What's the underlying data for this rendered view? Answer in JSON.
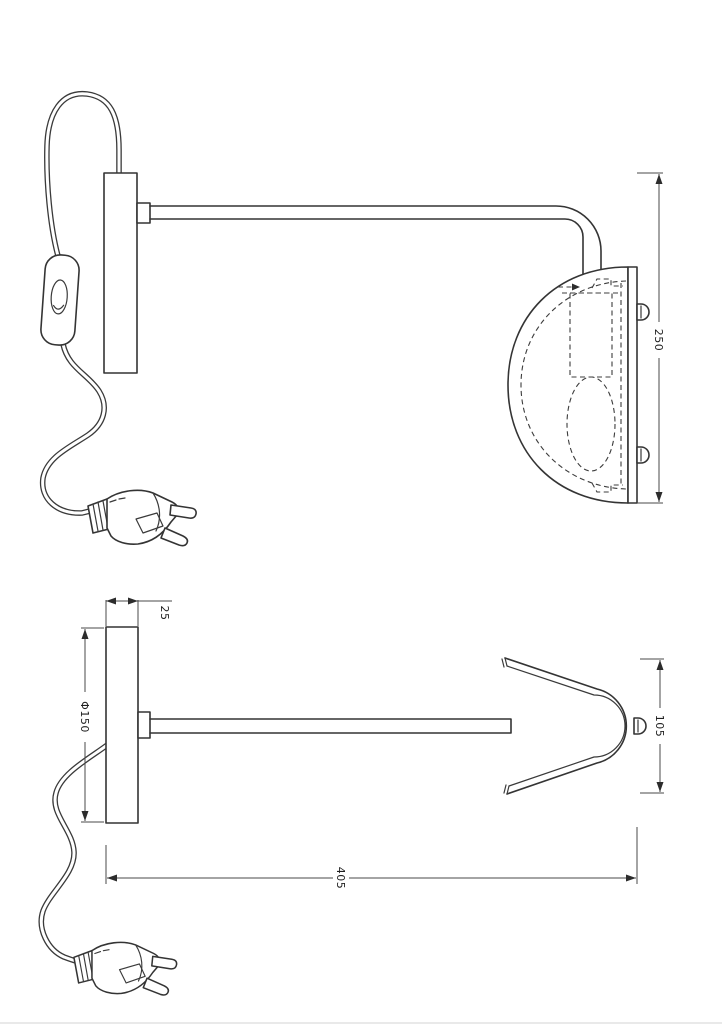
{
  "drawing": {
    "kind": "wall-lamp-technical-drawing",
    "views": {
      "side_elevation": {
        "dimensions": {
          "overall_height": {
            "label": "250"
          }
        }
      },
      "plan": {
        "dimensions": {
          "plate_thickness": {
            "label": "25"
          },
          "backplate_diameter": {
            "label": "Φ150"
          },
          "shade_width": {
            "label": "105"
          },
          "overall_projection": {
            "label": "405"
          }
        }
      }
    },
    "colors": {
      "background": "#ffffff",
      "line": "#343434",
      "dimension_line": "#4a4a4a",
      "dimension_text": "#1f1f1f"
    }
  }
}
